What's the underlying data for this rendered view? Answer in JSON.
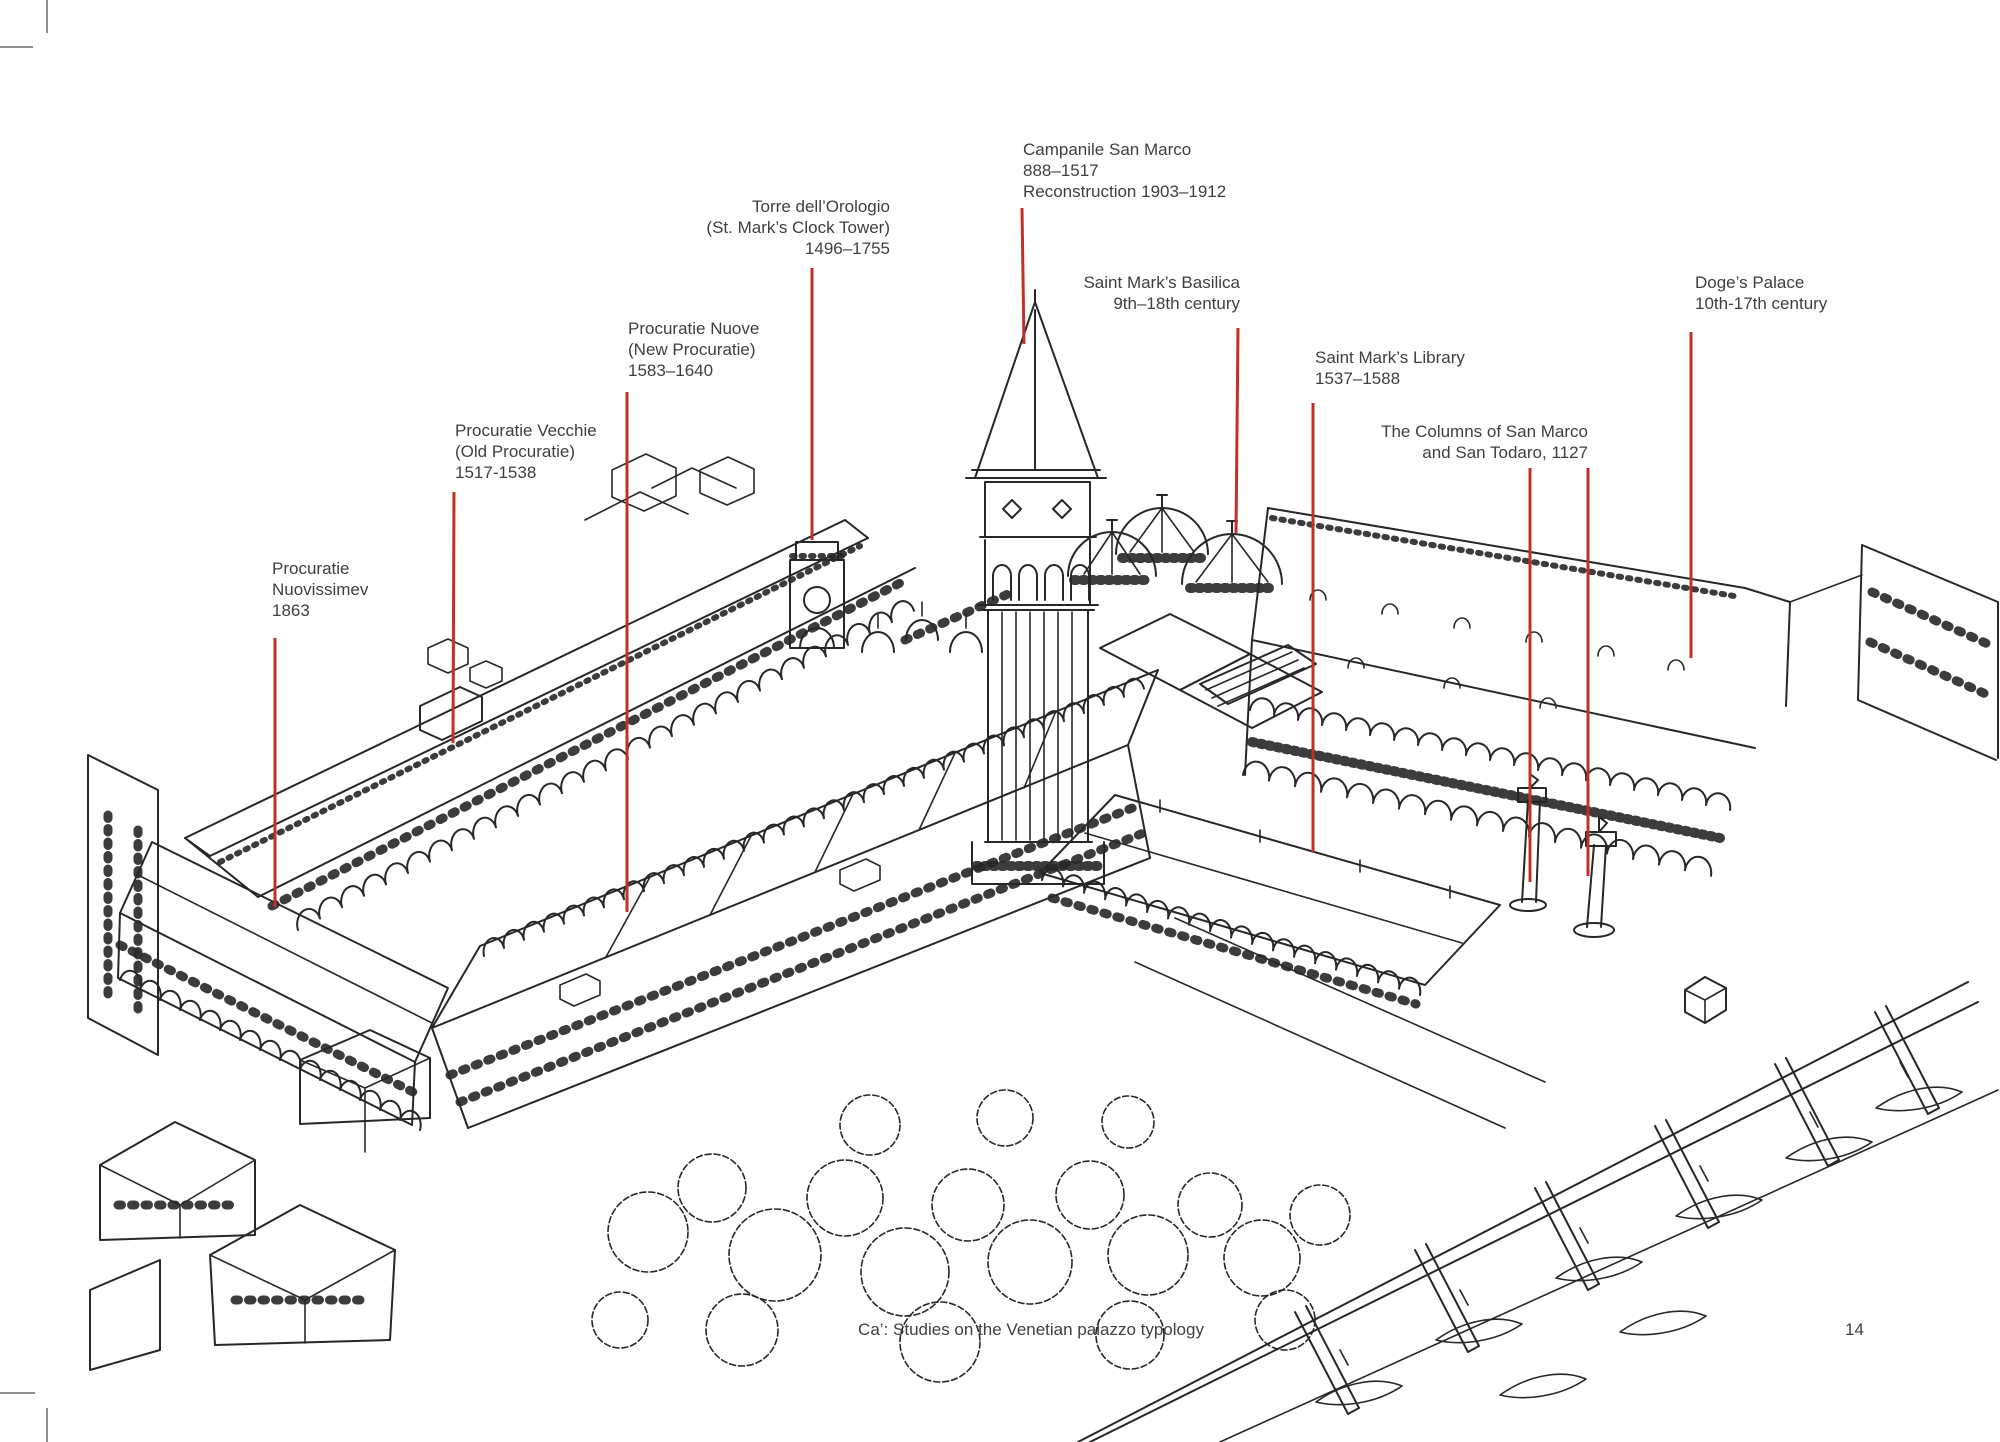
{
  "page": {
    "footer_caption": "Ca’: Studies on the Venetian palazzo typology",
    "page_number": "14"
  },
  "colors": {
    "ink": "#272727",
    "leader_red": "#c23028",
    "text": "#3f3f3f",
    "crop_mark": "#8f8f8f",
    "paper": "#ffffff"
  },
  "annotations": [
    {
      "id": "campanile",
      "align": "left",
      "lines": [
        "Campanile San Marco",
        "888–1517",
        "Reconstruction 1903–1912"
      ]
    },
    {
      "id": "torre-orologio",
      "align": "right",
      "lines": [
        "Torre dell’Orologio",
        "(St. Mark’s Clock Tower)",
        "1496–1755"
      ]
    },
    {
      "id": "basilica",
      "align": "right",
      "lines": [
        "Saint Mark’s Basilica",
        "9th–18th century"
      ]
    },
    {
      "id": "doges-palace",
      "align": "left",
      "lines": [
        "Doge’s Palace",
        "10th-17th century"
      ]
    },
    {
      "id": "procuratie-nuove",
      "align": "left",
      "lines": [
        "Procuratie Nuove",
        "(New Procuratie)",
        "1583–1640"
      ]
    },
    {
      "id": "saint-marks-library",
      "align": "left",
      "lines": [
        "Saint Mark’s Library",
        "1537–1588"
      ]
    },
    {
      "id": "procuratie-vecchie",
      "align": "left",
      "lines": [
        "Procuratie Vecchie",
        "(Old Procuratie)",
        "1517-1538"
      ]
    },
    {
      "id": "columns-san-marco-san-todaro",
      "align": "right",
      "lines": [
        "The Columns of San Marco",
        "and San Todaro, 1127"
      ]
    },
    {
      "id": "procuratie-nuovissime",
      "align": "left",
      "lines": [
        "Procuratie",
        "Nuovissimev",
        "1863"
      ]
    }
  ]
}
